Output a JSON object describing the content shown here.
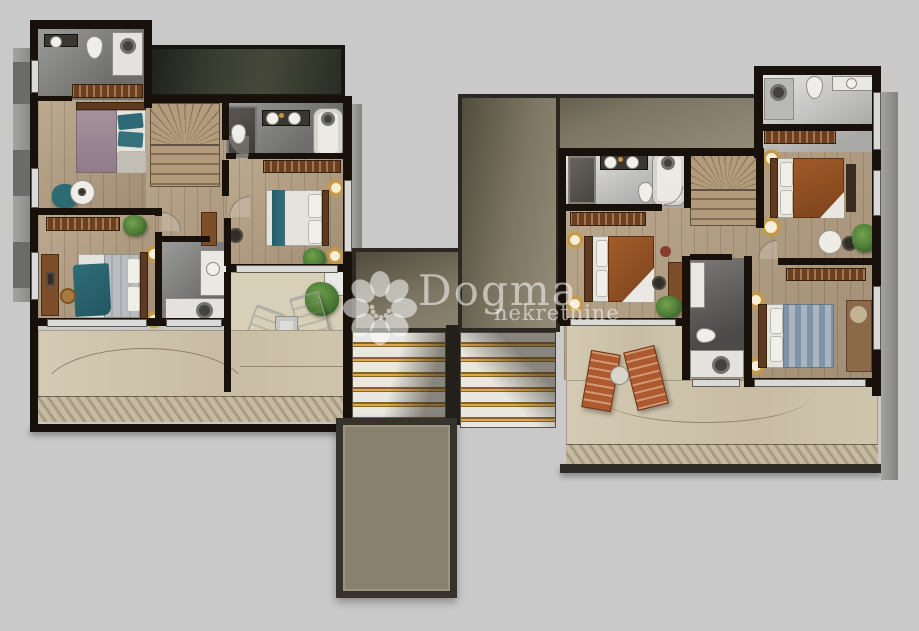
{
  "watermark": {
    "brand": "Dogma",
    "subtitle": "nekretnine",
    "logo": "dogma-flower-logo"
  },
  "palette": {
    "background": "#c9c9ca",
    "wall": "#18110b",
    "wood_floor": "#b39e81",
    "bathroom_floor_gray": "#8d8d8b",
    "terrace_beige": "#cfc5ad",
    "deck_stripe": "#a89c82",
    "roof_band_dark_green": "#3a3e32",
    "roof_taupe": "#89816f",
    "gold_accent": "#c6963f",
    "teal_textile": "#2d6a75",
    "mauve_textile": "#9b8792",
    "rust_textile": "#9a5526",
    "blue_gray_textile": "#8ea2b2",
    "plant_green": "#4c7b36",
    "window_glass": "#dadad8",
    "lounger_white": "#ecedec",
    "lounger_terracotta": "#ad5a30",
    "watermark_white": "rgba(255,255,255,0.55)"
  },
  "plans": [
    {
      "name": "left-unit-upper-floor",
      "rooms": [
        "bedroom-1",
        "bedroom-2",
        "bedroom-3",
        "bathroom-1",
        "bathroom-2",
        "bathroom-3",
        "staircase",
        "hallway",
        "terrace"
      ]
    },
    {
      "name": "right-unit-upper-floor",
      "rooms": [
        "bedroom-1",
        "bedroom-2",
        "bedroom-3",
        "bathroom-1",
        "bathroom-2",
        "bathroom-3",
        "staircase",
        "hallway",
        "terrace"
      ]
    }
  ]
}
